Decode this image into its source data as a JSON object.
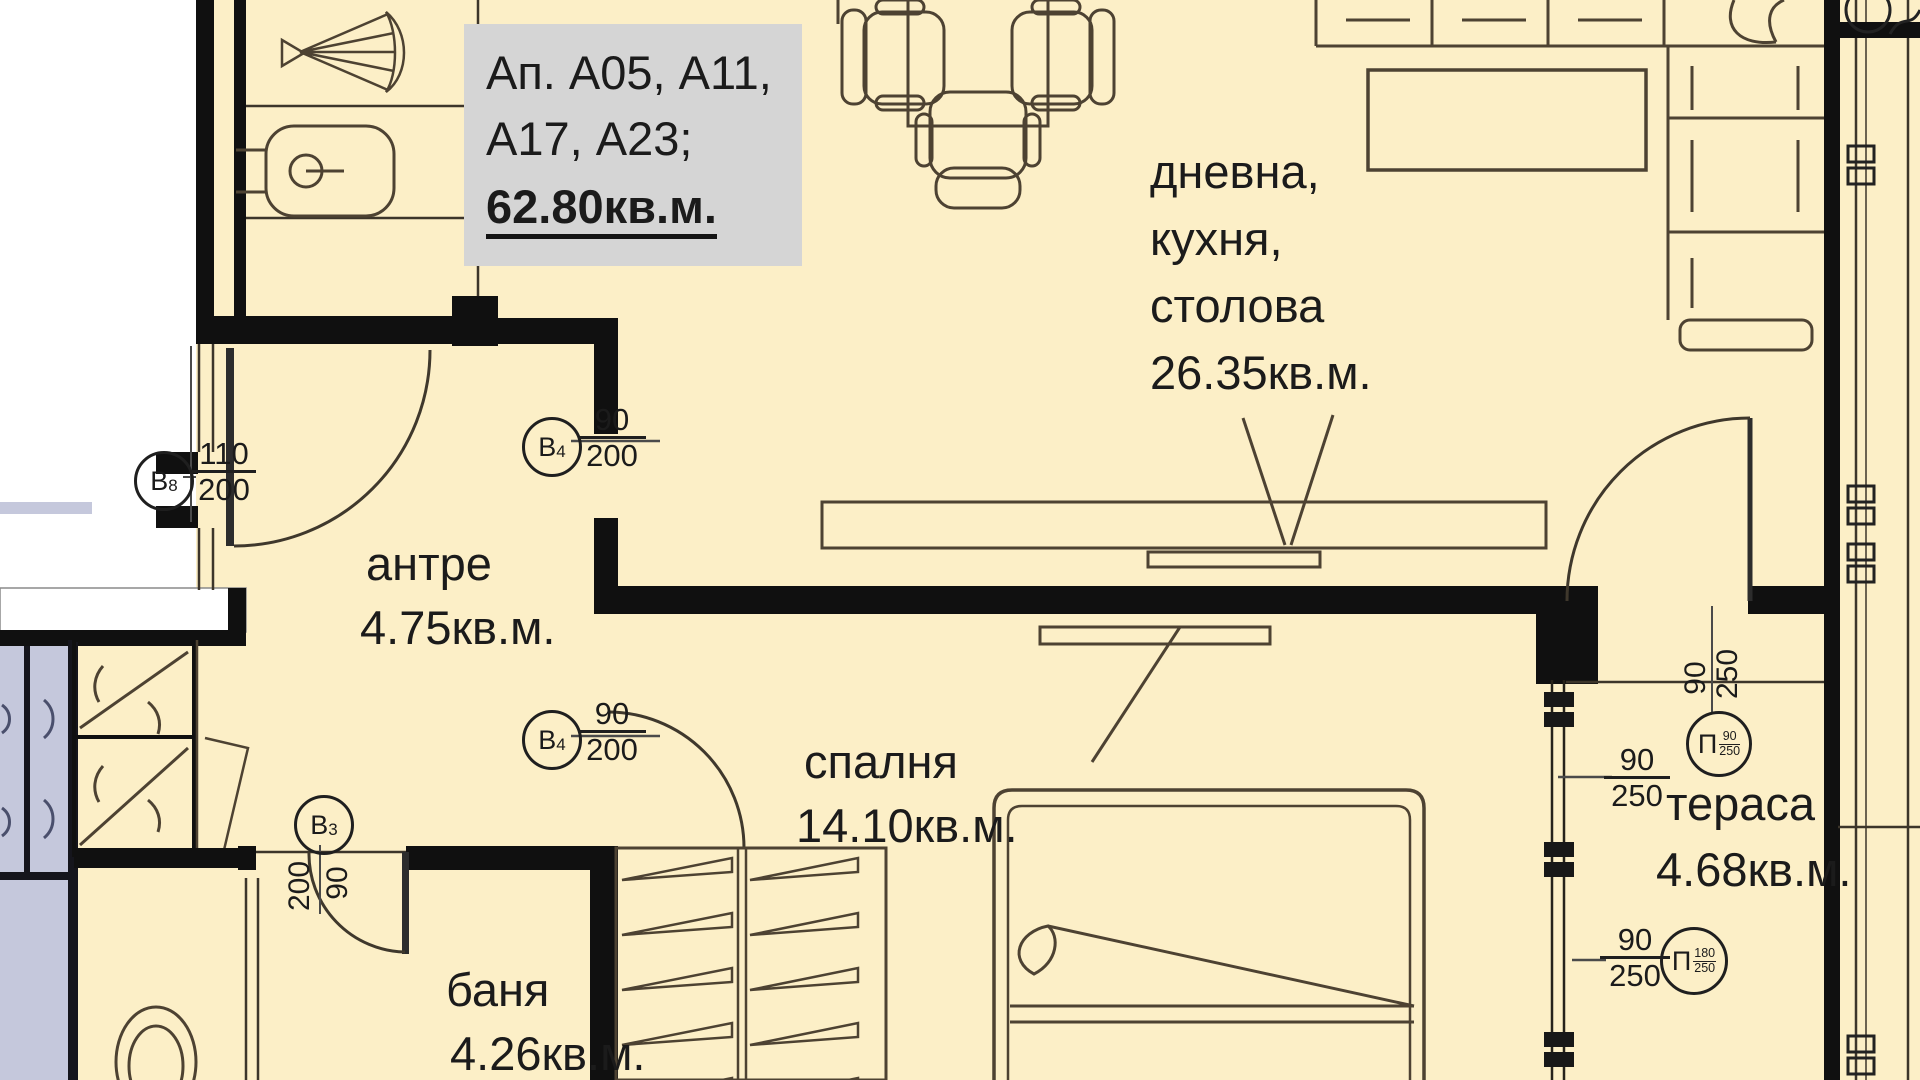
{
  "palette": {
    "bg": "#fcefc7",
    "outside": "#ffffff",
    "neighbor": "#c5c8dc",
    "wall": "#101010",
    "line": "#4d4232",
    "label_box_bg": "#d5d5d5",
    "text": "#1b1b1b"
  },
  "title_box": {
    "line1": "Ап. А05, А11,",
    "line2": "А17, А23;",
    "area": "62.80кв.м."
  },
  "rooms": {
    "living": {
      "l1": "дневна,",
      "l2": "кухня,",
      "l3": "столова",
      "area": "26.35кв.м."
    },
    "hall": {
      "name": "антре",
      "area": "4.75кв.м."
    },
    "bedroom": {
      "name": "спалня",
      "area": "14.10кв.м."
    },
    "bath": {
      "name": "баня",
      "area": "4.26кв.м."
    },
    "terrace": {
      "name": "тераса",
      "area": "4.68кв.м."
    }
  },
  "markers": {
    "b8": {
      "label": "В",
      "sub": "8",
      "num": "110",
      "den": "200"
    },
    "b4a": {
      "label": "В",
      "sub": "4",
      "num": "90",
      "den": "200"
    },
    "b4b": {
      "label": "В",
      "sub": "4",
      "num": "90",
      "den": "200"
    },
    "b3": {
      "label": "В",
      "sub": "3",
      "num": "90",
      "den": "200"
    },
    "p1": {
      "label": "П",
      "sub_num": "90",
      "sub_den": "250",
      "h_num": "90",
      "h_den": "250",
      "v_num": "90",
      "v_den": "250"
    },
    "p2": {
      "label": "П",
      "sub_num": "180",
      "sub_den": "250",
      "h_num": "90",
      "h_den": "250"
    }
  }
}
